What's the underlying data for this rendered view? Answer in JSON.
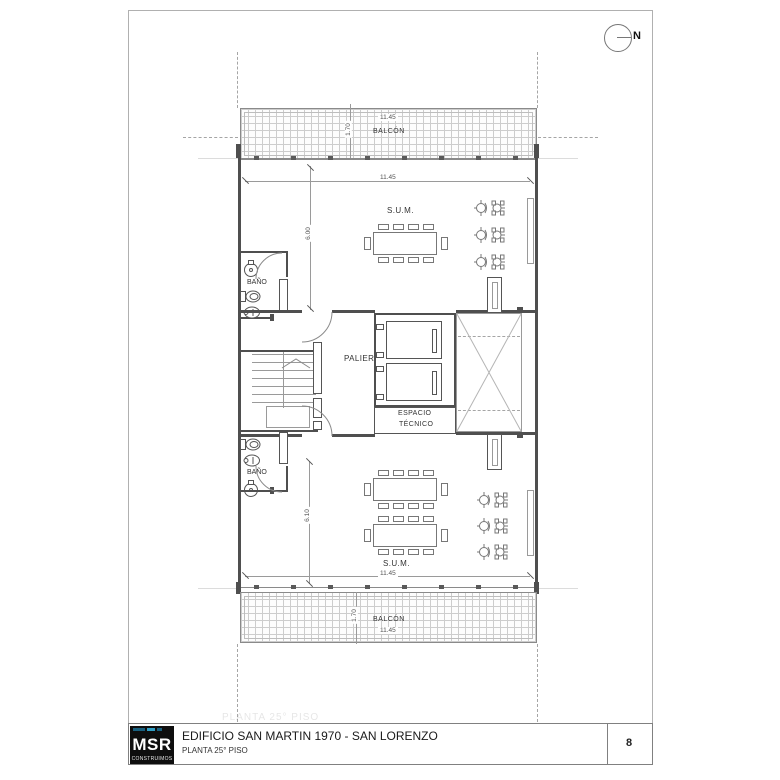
{
  "north": {
    "label": "N"
  },
  "plan": {
    "balcony_top": {
      "label": "BALCÓN",
      "width_dim": "11.45",
      "depth_dim": "1.70"
    },
    "sum_top": {
      "label": "S.U.M.",
      "width_dim": "11.45",
      "height_dim": "6.00"
    },
    "bath_top": {
      "label": "BAÑO"
    },
    "palier": {
      "label": "PALIER"
    },
    "tech_space": {
      "label_line1": "ESPACIO",
      "label_line2": "TÉCNICO"
    },
    "bath_bottom": {
      "label": "BAÑO"
    },
    "sum_bottom": {
      "label": "S.U.M.",
      "width_dim": "11.45",
      "height_dim": "6.10"
    },
    "balcony_bottom": {
      "label": "BALCÓN",
      "width_dim": "11.45",
      "depth_dim": "1.70"
    }
  },
  "ghost_text": "PLANTA  25° PISO",
  "title_block": {
    "logo_text": "MSR",
    "logo_subtext": "CONSTRUIMOS",
    "project_title": "EDIFICIO SAN MARTIN 1970 - SAN LORENZO",
    "sheet_subtitle": "PLANTA  25° PISO",
    "sheet_number": "8"
  },
  "colors": {
    "logo_accent": "#2f9ec4",
    "wall": "#4f4f4f"
  }
}
